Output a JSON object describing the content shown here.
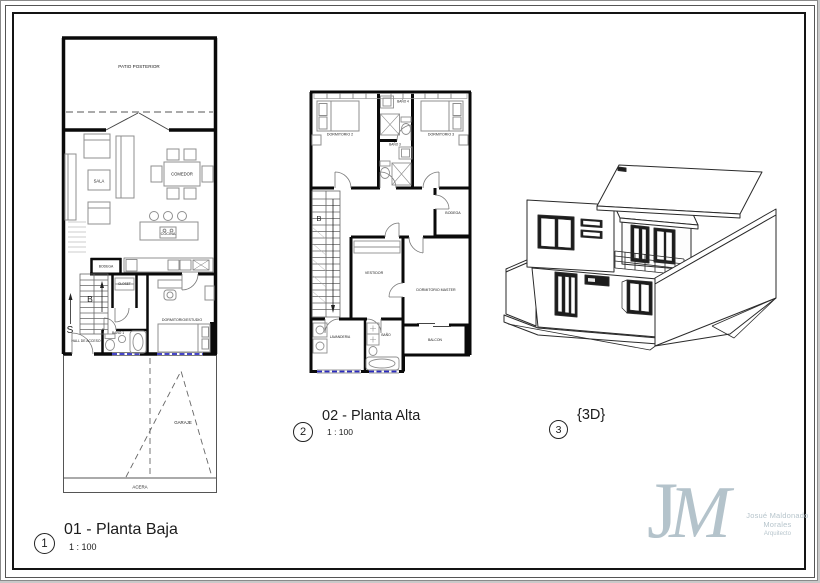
{
  "palette": {
    "ink": "#1a1a1a",
    "wall": "#0a0a0a",
    "furniture": "#8f8f8f",
    "glazing": "#2b2bc0",
    "logo": "#b4c3cb"
  },
  "views": {
    "baja": {
      "number": "1",
      "title": "01 - Planta Baja",
      "scale": "1 : 100",
      "labels": {
        "patio": "PATIO POSTERIOR",
        "sala": "SALA",
        "comedor": "COMEDOR",
        "cocina": "COCINA",
        "bodega": "BODEGA",
        "closet": "CLOSET",
        "dormitorio_estudio": "DORMITORIO/ESTUDIO",
        "hall": "HALL DE ACCESO",
        "bano1": "BAÑO 1",
        "garaje": "GARAJE",
        "acera": "ACERA",
        "stair_up": "S",
        "stair_down": "B"
      }
    },
    "alta": {
      "number": "2",
      "title": "02 - Planta Alta",
      "scale": "1 : 100",
      "labels": {
        "dormitorio2": "DORMITORIO 2",
        "bano4": "BAÑO 4",
        "dormitorio3": "DORMITORIO 3",
        "bano3": "BAÑO 3",
        "bodega": "BODEGA",
        "vestidor": "VESTIDOR",
        "master": "DORMITORIO MASTER",
        "lavanderia": "LAVANDERIA",
        "bano": "BAÑO",
        "balcon": "BALCON",
        "stair_down": "B"
      }
    },
    "three_d": {
      "number": "3",
      "title": "{3D}"
    }
  },
  "logo": {
    "monogram_j": "J",
    "monogram_m": "M",
    "name": "Josué Maldonado Morales",
    "role": "Arquitecto"
  }
}
